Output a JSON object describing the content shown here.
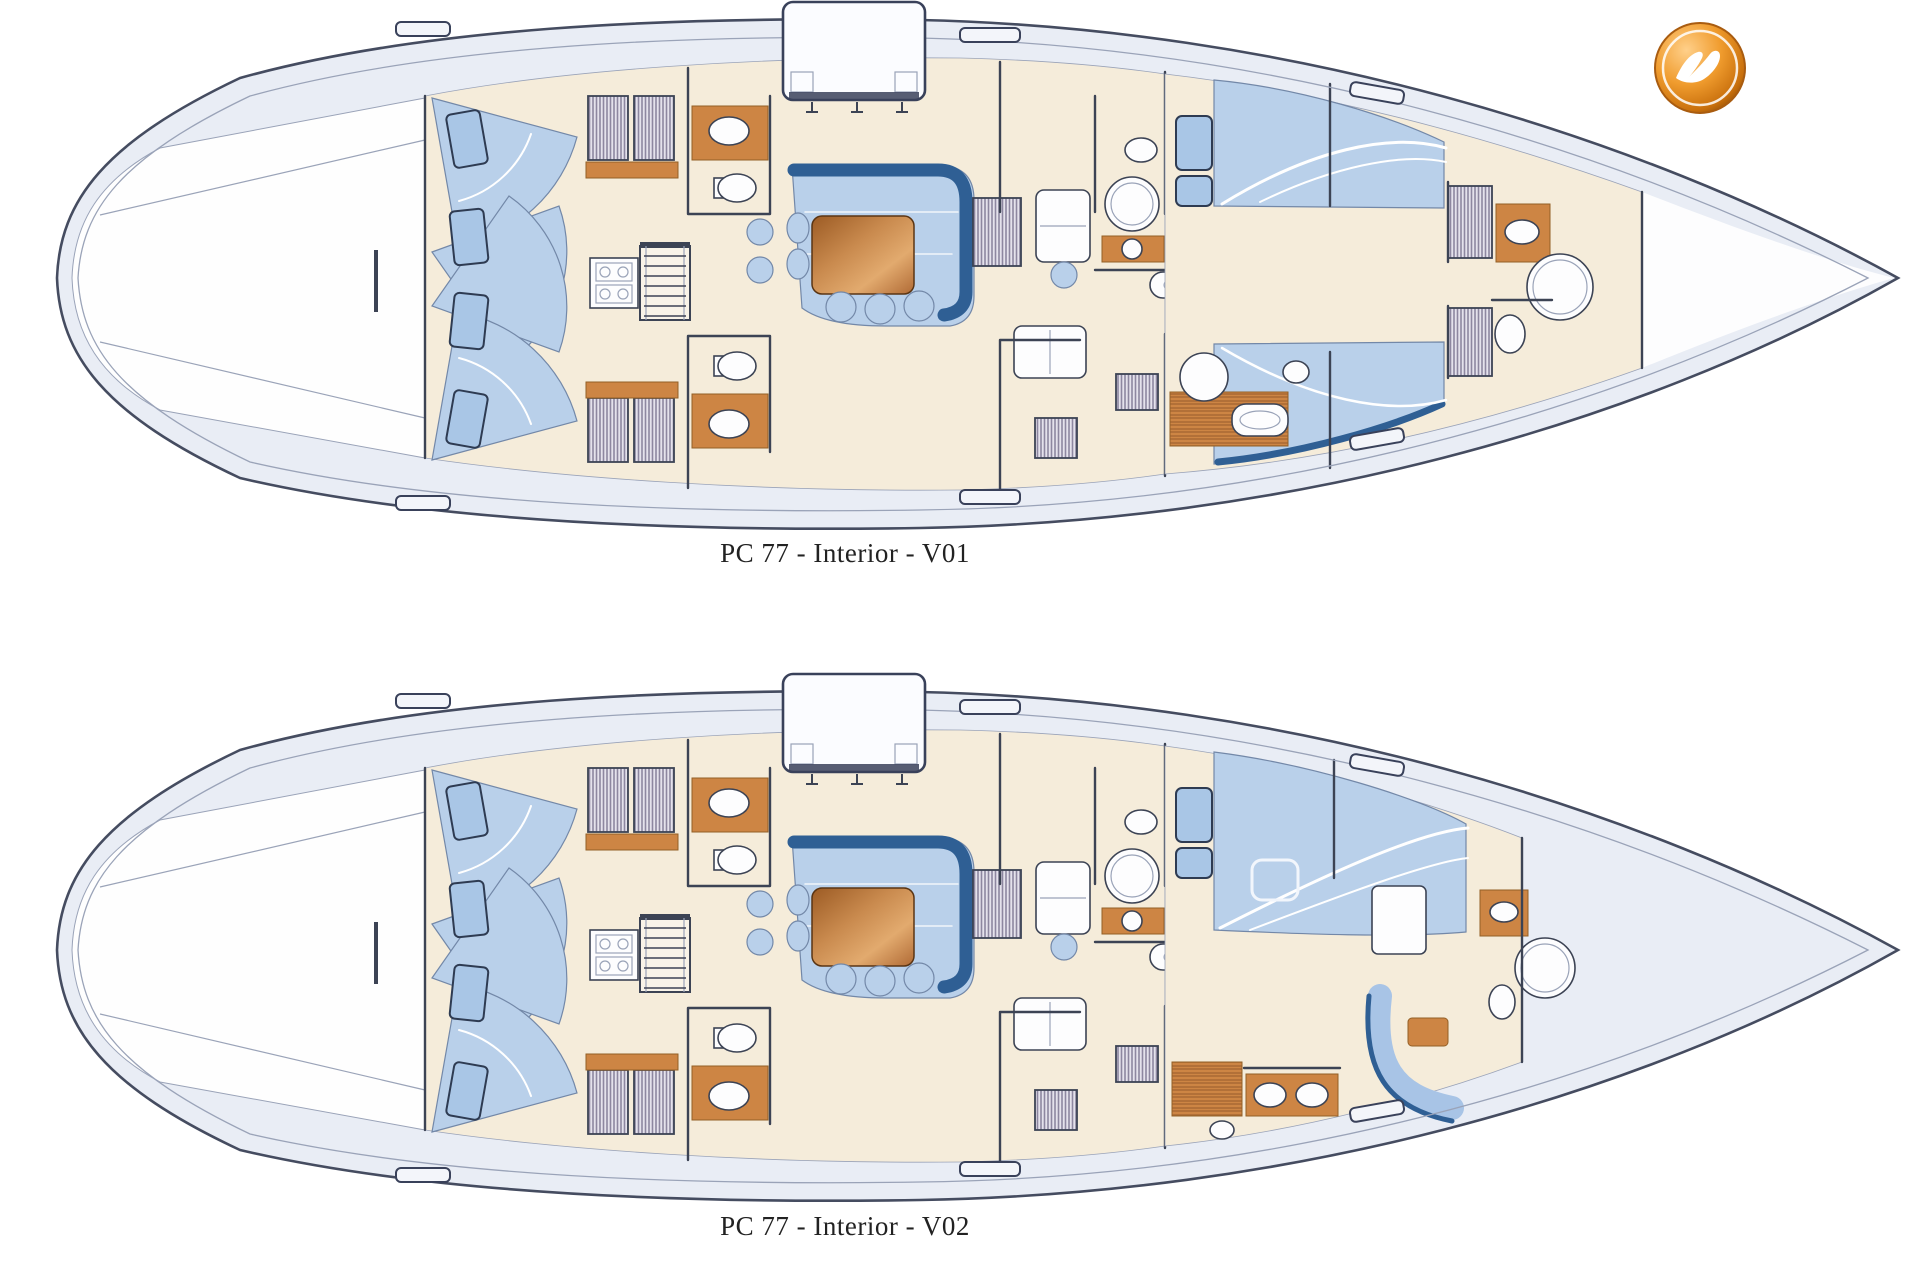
{
  "document": {
    "type": "yacht-interior-floorplan-sheet",
    "background": "#ffffff",
    "boat_model": "PC 77"
  },
  "plans": [
    {
      "id": "V01",
      "caption": "PC 77 - Interior - V01"
    },
    {
      "id": "V02",
      "caption": "PC 77 - Interior - V02"
    }
  ],
  "logo": {
    "name": "shipyard-logo",
    "description": "glossy orange sphere with white bird glyph and white inner ring"
  },
  "palette": {
    "deck": "#e9edf5",
    "deckLight": "#f3f5fa",
    "floor": "#f5ecda",
    "floorShade": "#f8f3e8",
    "cushion": "#b9d0ea",
    "cushionLight": "#cddcf0",
    "accentBlue": "#2f5f94",
    "wood": "#cd8544",
    "woodDark": "#a96a33",
    "line": "#3c4354",
    "lineSoft": "#9aa3b8",
    "hatchInk": "#8d87a0",
    "hatchBg": "#e4e2ec",
    "white": "#fdfdfe",
    "captionColor": "#222222",
    "logoOrange": "#e07f10",
    "logoOrangeLight": "#f7b24a",
    "logoOrangeDark": "#7d4404"
  }
}
